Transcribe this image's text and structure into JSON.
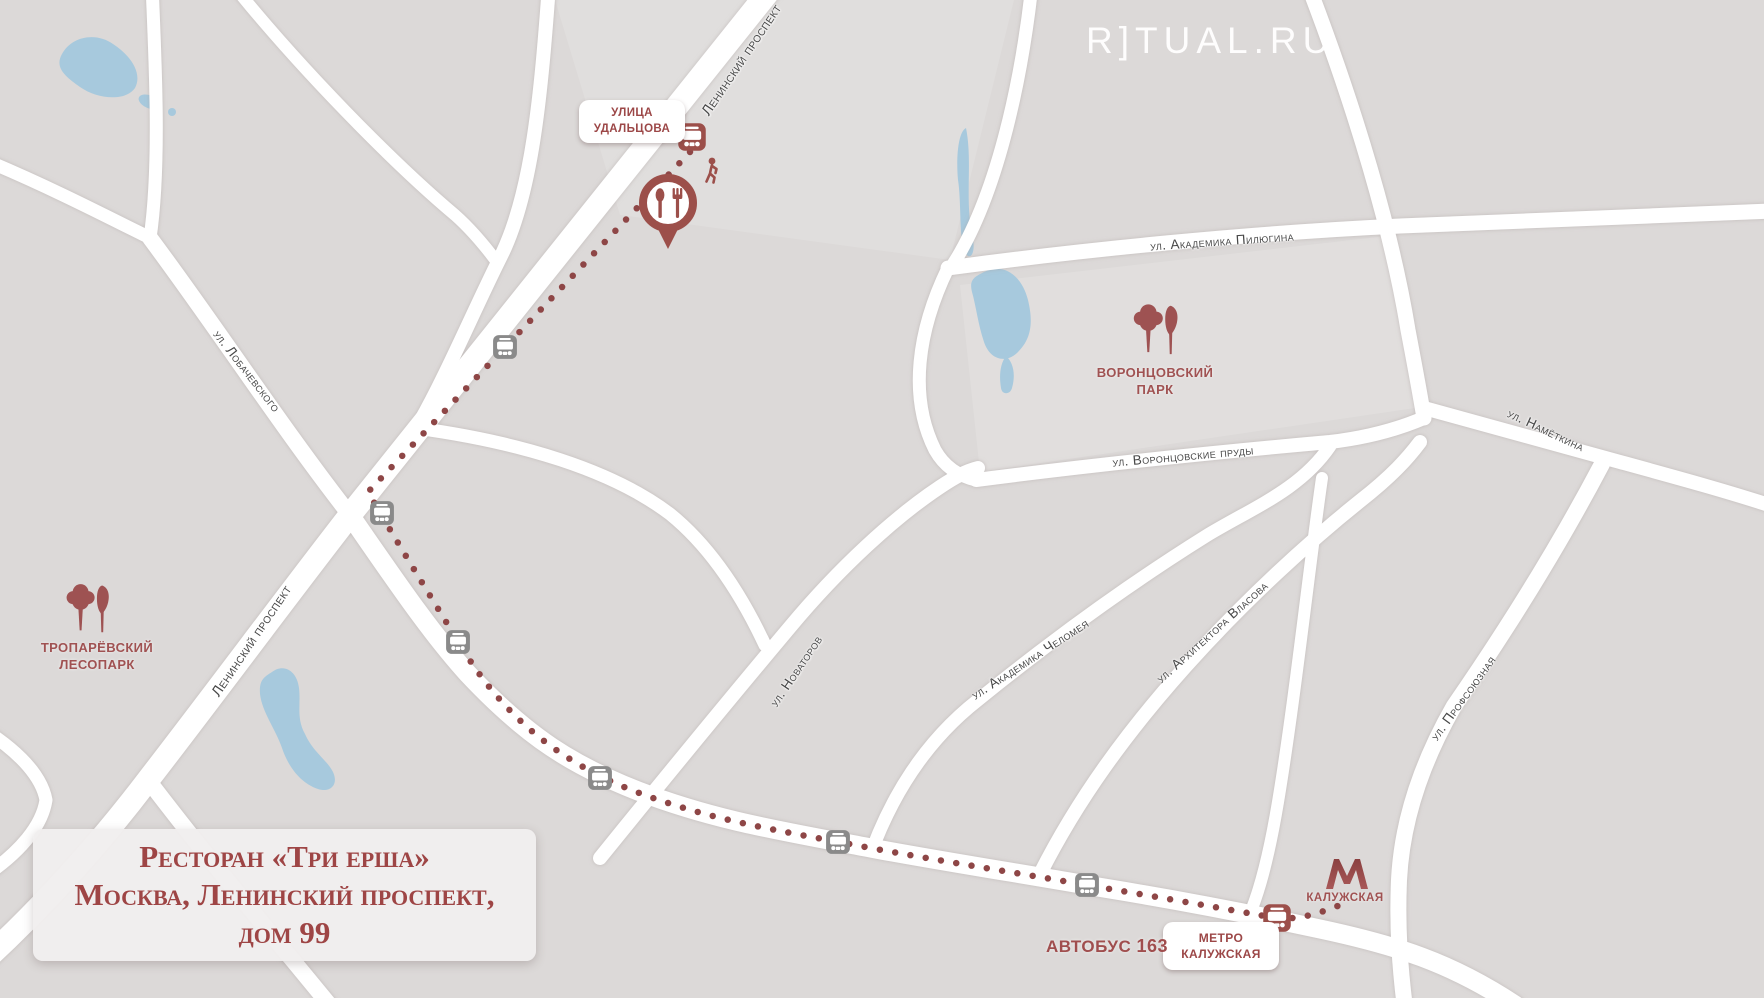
{
  "brand": {
    "logo": "R]TUAL.RU"
  },
  "title_card": {
    "line1": "Ресторан «Три ерша»",
    "line2": "Москва, Ленинский проспект,",
    "line3": "дом 99"
  },
  "route": {
    "bus_label": "АВТОБУС",
    "bus_number": "163",
    "metro_stop": {
      "line1": "МЕТРО",
      "line2": "КАЛУЖСКАЯ"
    },
    "street_stop": {
      "line1": "УЛИЦА",
      "line2": "УДАЛЬЦОВА"
    }
  },
  "metro": {
    "station": "КАЛУЖСКАЯ"
  },
  "parks": [
    {
      "line1": "ВОРОНЦОВСКИЙ",
      "line2": "ПАРК"
    },
    {
      "line1": "ТРОПАРЁВСКИЙ",
      "line2": "ЛЕСОПАРК"
    }
  ],
  "streets": [
    "Ленинский проспект",
    "Ленинский проспект",
    "ул. Лобачевского",
    "ул. Академика Пилюгина",
    "ул. Воронцовские пруды",
    "ул. Новаторов",
    "ул. Академика Челомея",
    "ул. Архитектора Власова",
    "ул. Намёткина",
    "ул. Профсоюзная"
  ],
  "colors": {
    "accent": "#9c4f4a",
    "route_dots": "#8e4646",
    "water": "#a7c9dd",
    "background": "#dcd9d8",
    "road": "#ffffff",
    "street_text": "#474747",
    "bus_gray": "#8a8a8a"
  }
}
